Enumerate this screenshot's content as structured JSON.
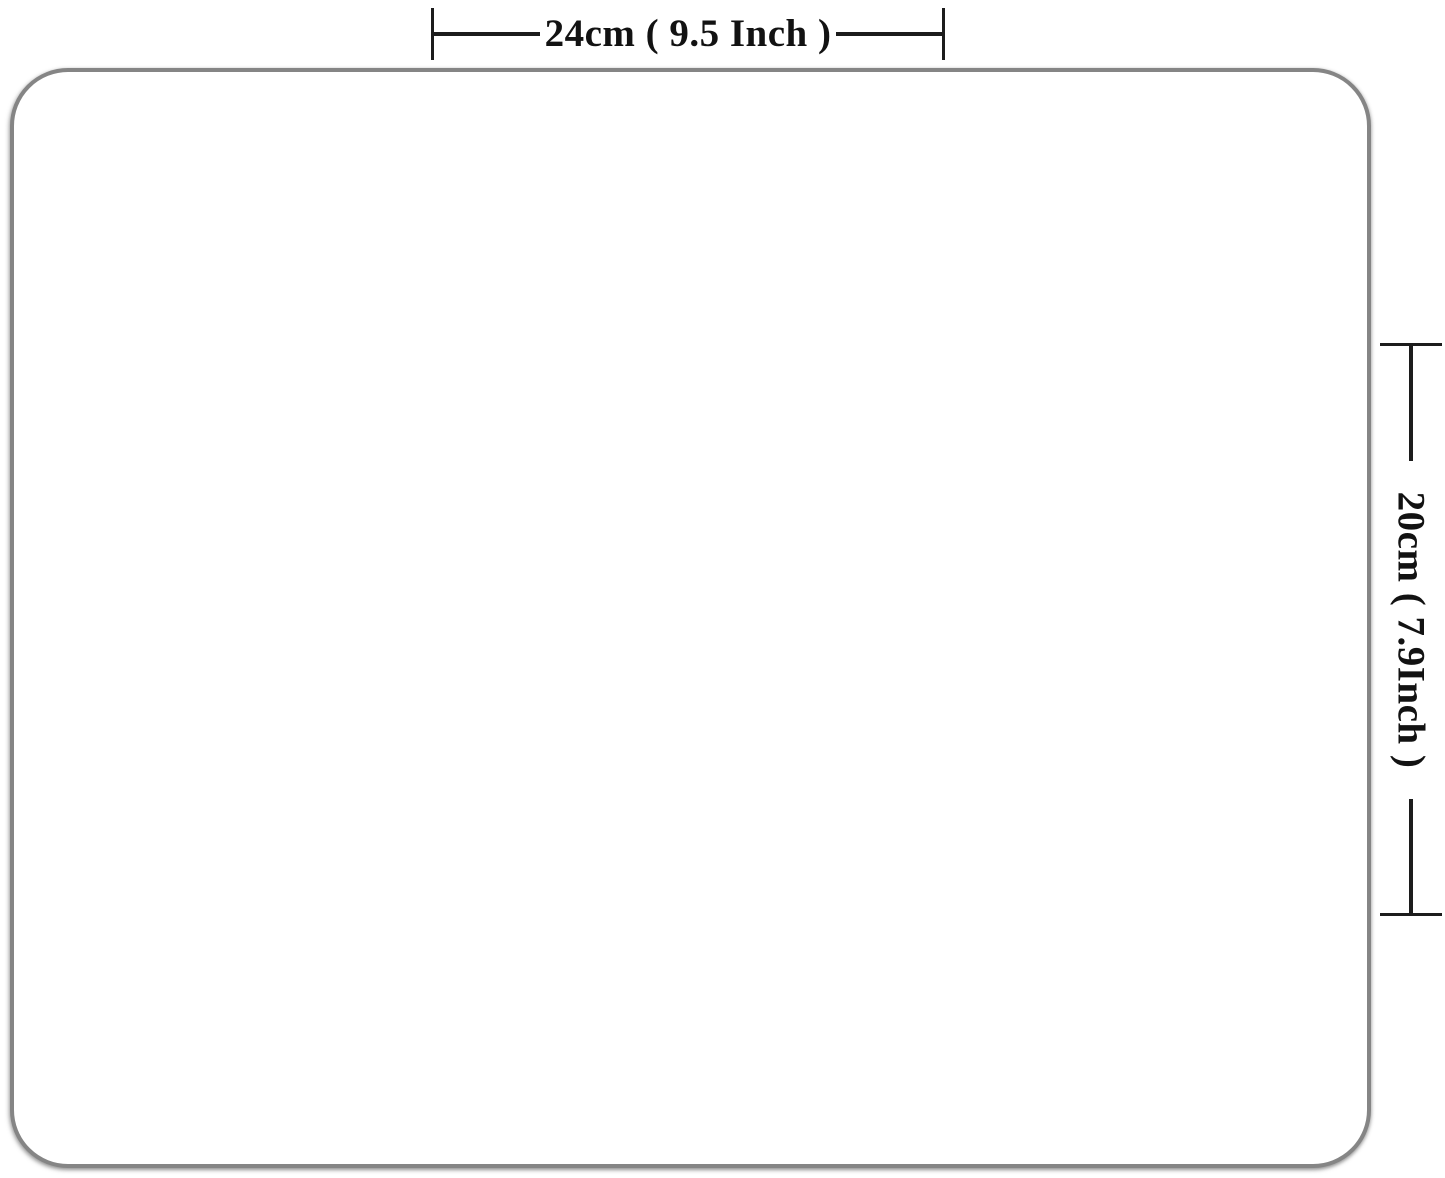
{
  "diagram": {
    "surface": {
      "fill": "#ffffff",
      "border_color": "#858585"
    },
    "dimensions": {
      "width": {
        "label": "24cm ( 9.5  Inch )"
      },
      "height": {
        "label": "20cm ( 7.9Inch )"
      }
    },
    "colors": {
      "dimension_line": "#1c1c1c",
      "background": "#ffffff"
    }
  }
}
